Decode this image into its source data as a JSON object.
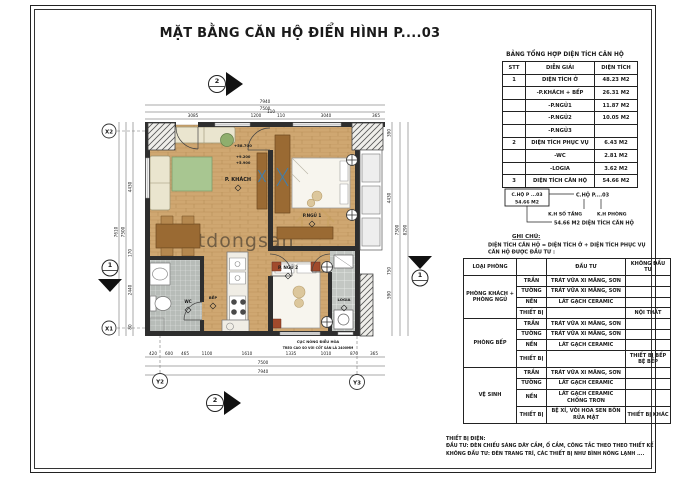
{
  "title": "MẶT BẰNG CĂN HỘ ĐIỂN HÌNH P....03",
  "area_table": {
    "title": "BẢNG TỔNG HỢP DIỆN TÍCH CĂN HỘ",
    "headers": [
      "STT",
      "DIỄN GIẢI",
      "DIỆN TÍCH"
    ],
    "rows": [
      [
        "1",
        "DIỆN TÍCH Ở",
        "48.23 M2"
      ],
      [
        "",
        "-P.KHÁCH + BẾP",
        "26.31 M2"
      ],
      [
        "",
        "-P.NGỦ1",
        "11.87 M2"
      ],
      [
        "",
        "-P.NGỦ2",
        "10.05 M2"
      ],
      [
        "",
        "-P.NGỦ3",
        ""
      ],
      [
        "2",
        "DIỆN TÍCH PHỤC VỤ",
        "6.43 M2"
      ],
      [
        "",
        "-WC",
        "2.81 M2"
      ],
      [
        "",
        "-LOGIA",
        "3.62 M2"
      ],
      [
        "3",
        "DIỆN TÍCH CĂN HỘ",
        "54.66 M2"
      ]
    ]
  },
  "key_diagram": {
    "box_line1": "C.HỘ P ...03",
    "box_line2": "54.66 M2",
    "ref_label": "C.HỘ P....03",
    "floor_label": "K.H SỐ TẦNG",
    "room_label": "K.H PHÒNG",
    "area_label": "54.66 M2 DIỆN TÍCH CĂN HỘ",
    "note_title": "GHI CHÚ:",
    "note_line1": "DIỆN TÍCH CĂN HỘ = DIỆN TÍCH Ở + DIỆN TÍCH PHỤC VỤ",
    "note_line2": "CĂN HỘ ĐƯỢC ĐẦU TƯ :"
  },
  "invest_table": {
    "headers": [
      "LOẠI PHÒNG",
      "",
      "ĐẦU TƯ",
      "KHÔNG ĐẦU TƯ"
    ],
    "groups": [
      {
        "room": "PHÒNG KHÁCH + PHÒNG NGỦ",
        "rows": [
          [
            "TRẦN",
            "TRÁT VỮA XI MĂNG, SƠN",
            ""
          ],
          [
            "TƯỜNG",
            "TRÁT VỮA XI MĂNG, SƠN",
            ""
          ],
          [
            "NỀN",
            "LÁT GẠCH CERAMIC",
            ""
          ],
          [
            "THIẾT BỊ",
            "",
            "NỘI THẤT"
          ]
        ]
      },
      {
        "room": "PHÒNG BẾP",
        "rows": [
          [
            "TRẦN",
            "TRÁT VỮA XI MĂNG, SƠN",
            ""
          ],
          [
            "TƯỜNG",
            "TRÁT VỮA XI MĂNG, SƠN",
            ""
          ],
          [
            "NỀN",
            "LÁT GẠCH CERAMIC",
            ""
          ],
          [
            "THIẾT BỊ",
            "",
            "THIẾT BỊ BẾP BỆ BẾP"
          ]
        ]
      },
      {
        "room": "VỆ SINH",
        "rows": [
          [
            "TRẦN",
            "TRÁT VỮA XI MĂNG, SƠN",
            ""
          ],
          [
            "TƯỜNG",
            "LÁT GẠCH CERAMIC",
            ""
          ],
          [
            "NỀN",
            "LÁT GẠCH CERAMIC CHỐNG TRƠN",
            ""
          ],
          [
            "THIẾT BỊ",
            "BỆ XÍ, VÒI HOA SEN BỒN RỬA MẶT",
            "THIẾT BỊ KHÁC"
          ]
        ]
      }
    ]
  },
  "footer_note": {
    "line1": "THIẾT BỊ ĐIỆN:",
    "line2": "ĐẦU TƯ: ĐÈN CHIẾU SÁNG DÂY CẮM, Ổ CẮM, CÔNG TẮC THEO THEO THIẾT KẾ",
    "line3": "KHÔNG ĐẦU TƯ: ĐÈN TRANG TRÍ, CÁC THIẾT BỊ NHƯ BÌNH NÓNG LẠNH ...."
  },
  "plan": {
    "rooms": {
      "khach": "P. KHÁCH",
      "ngu1": "P.NGỦ 1",
      "ngu2": "P. NGỦ 2",
      "logia": "LOGIA",
      "wc": "WC",
      "bep": "BẾP"
    },
    "levels": [
      "+58.700",
      "+9.200",
      "+5.900"
    ],
    "note1": "CỤC NÓNG ĐIỀU HÒA",
    "note2": "TREO CAO SO VỚI CỐT SÀN LÀ 2400MM",
    "grid": {
      "x1": "X1",
      "x2": "X2",
      "y2": "Y2",
      "y3": "Y3"
    },
    "section": {
      "s1": "1",
      "s2": "2"
    },
    "dims": {
      "top": [
        "3085",
        "1200",
        "110",
        "110",
        "3040",
        "365"
      ],
      "top_t1": "7500",
      "top_t2": "7940",
      "bottom": [
        "420",
        "600",
        "465",
        "1100",
        "1610",
        "1335",
        "1010",
        "870",
        "365"
      ],
      "bottom_t1": "7500",
      "bottom_t2": "7940",
      "left": [
        "4430",
        "170",
        "2440",
        "80"
      ],
      "left_t1": "7500",
      "left_t2": "7610",
      "right": [
        "390",
        "4430",
        "750",
        "590"
      ],
      "right_t1": "7500",
      "right_t2": "8290"
    },
    "watermark": "batdongsan"
  },
  "colors": {
    "wood_floor": "#cfa771",
    "tile_gray": "#c3c7c3",
    "accent_green": "#a8c691",
    "motif_blue": "#3f7fae",
    "wall": "#2e2e2e",
    "watermark_tan": "#c8a25f"
  }
}
